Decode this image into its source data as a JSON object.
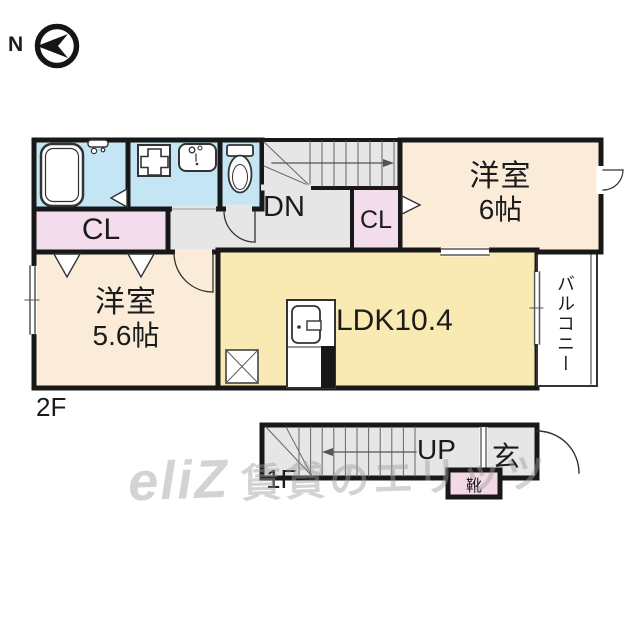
{
  "compass": {
    "north_label": "N"
  },
  "floor_2f": {
    "floor_label": "2F",
    "stairs_label": "DN",
    "closet_left_label": "CL",
    "closet_middle_label": "CL",
    "bedroom_right": {
      "name": "洋室",
      "size": "6帖"
    },
    "bedroom_left": {
      "name": "洋室",
      "size": "5.6帖"
    },
    "ldk_label": "LDK10.4",
    "balcony_label": "バルコニー"
  },
  "floor_1f": {
    "floor_label": "1F",
    "stairs_label": "UP",
    "entrance_label": "玄",
    "shoe_box_label": "靴"
  },
  "watermark": {
    "logo": "eliZ",
    "text": "賃貸のエリッツ"
  },
  "colors": {
    "wall": "#181818",
    "wet_area_blue": "#c3e5f4",
    "closet_pink": "#f3dcec",
    "bedroom_cream": "#faecd9",
    "ldk_yellow": "#f8eab2",
    "hall_gray": "#e6e6e6",
    "shoe_box_pink": "#f3d9e6",
    "watermark_gray": "#9e9e9e"
  }
}
